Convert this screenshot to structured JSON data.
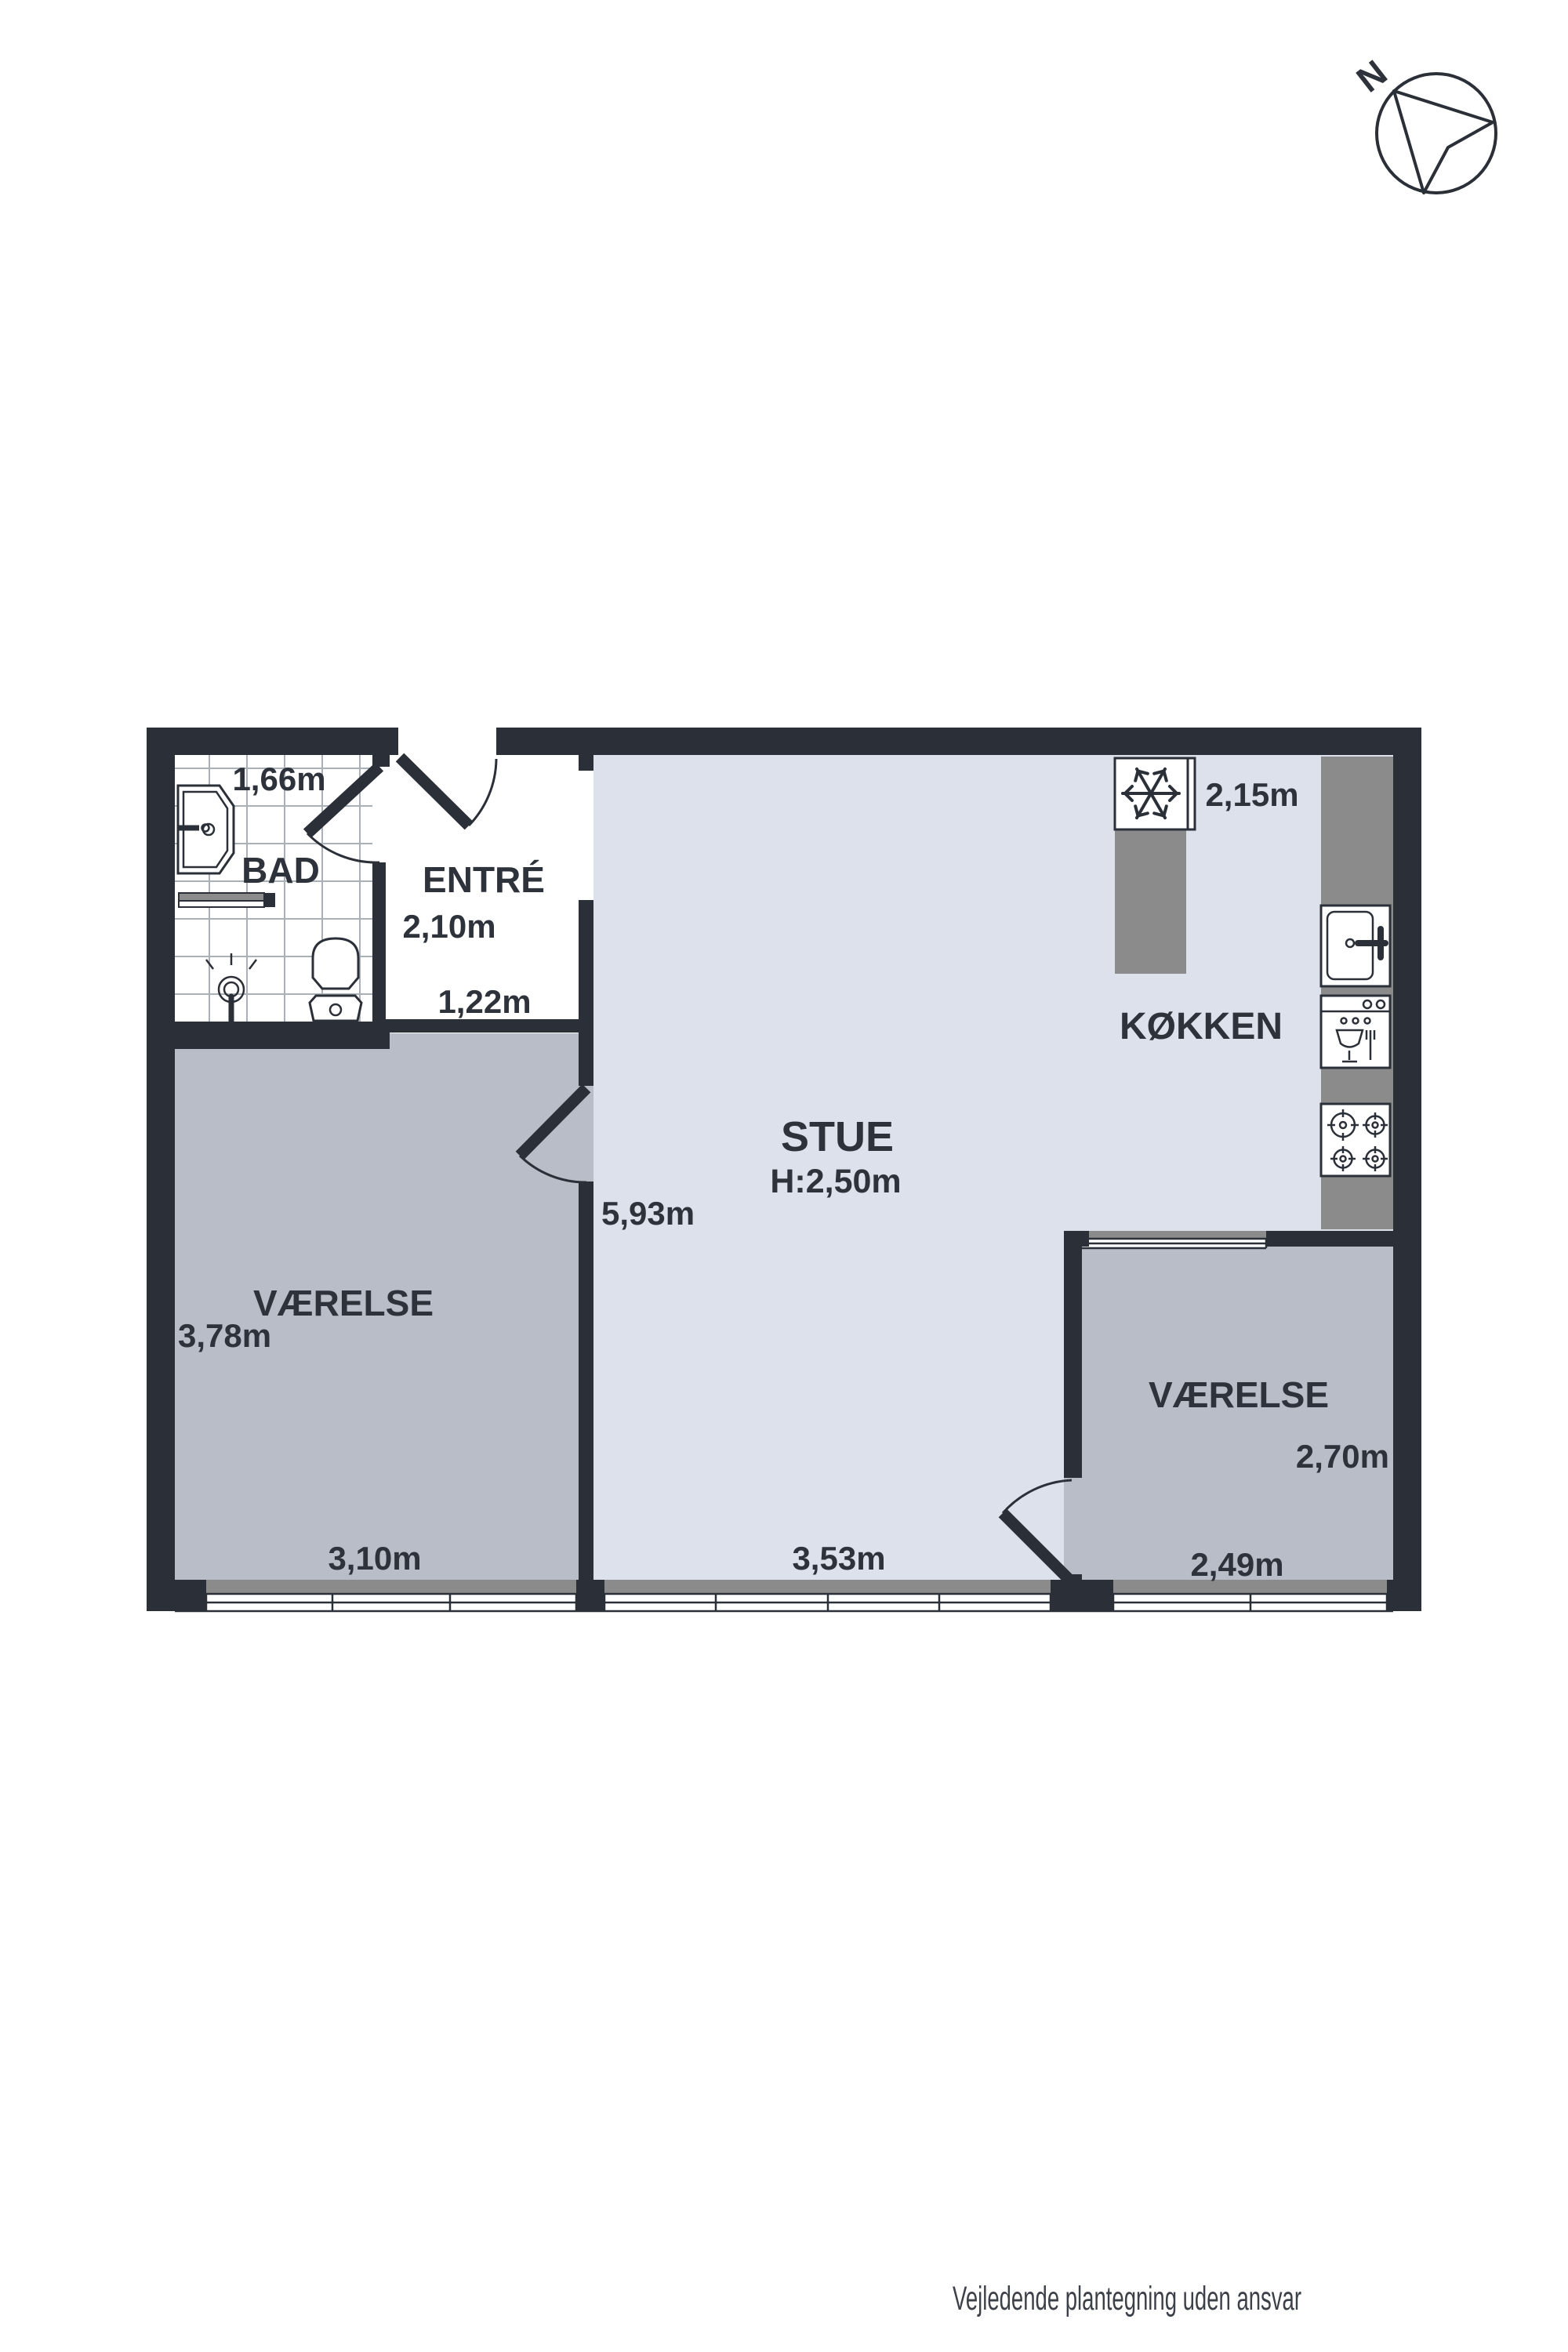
{
  "footer": {
    "disclaimer": "Vejledende plantegning uden ansvar"
  },
  "compass": {
    "north_label": "N"
  },
  "rooms": {
    "bad": {
      "name": "BAD",
      "width": "1,66m"
    },
    "entre": {
      "name": "ENTRÉ",
      "width": "2,10m",
      "depth": "1,22m"
    },
    "stue": {
      "name": "STUE",
      "ceiling_height": "H:2,50m",
      "length": "5,93m",
      "width": "3,53m"
    },
    "koekken": {
      "name": "KØKKEN",
      "width": "2,15m"
    },
    "vaerelse_vest": {
      "name": "VÆRELSE",
      "length": "3,78m",
      "width": "3,10m"
    },
    "vaerelse_syd": {
      "name": "VÆRELSE",
      "length": "2,70m",
      "width": "2,49m"
    }
  },
  "colors": {
    "wall": "#2b3038",
    "floor_main": "#dce1ec",
    "floor_room": "#b8bdc8",
    "counter": "#8b8b8c",
    "tile_line": "#aab0b8",
    "text": "#2e333b"
  }
}
